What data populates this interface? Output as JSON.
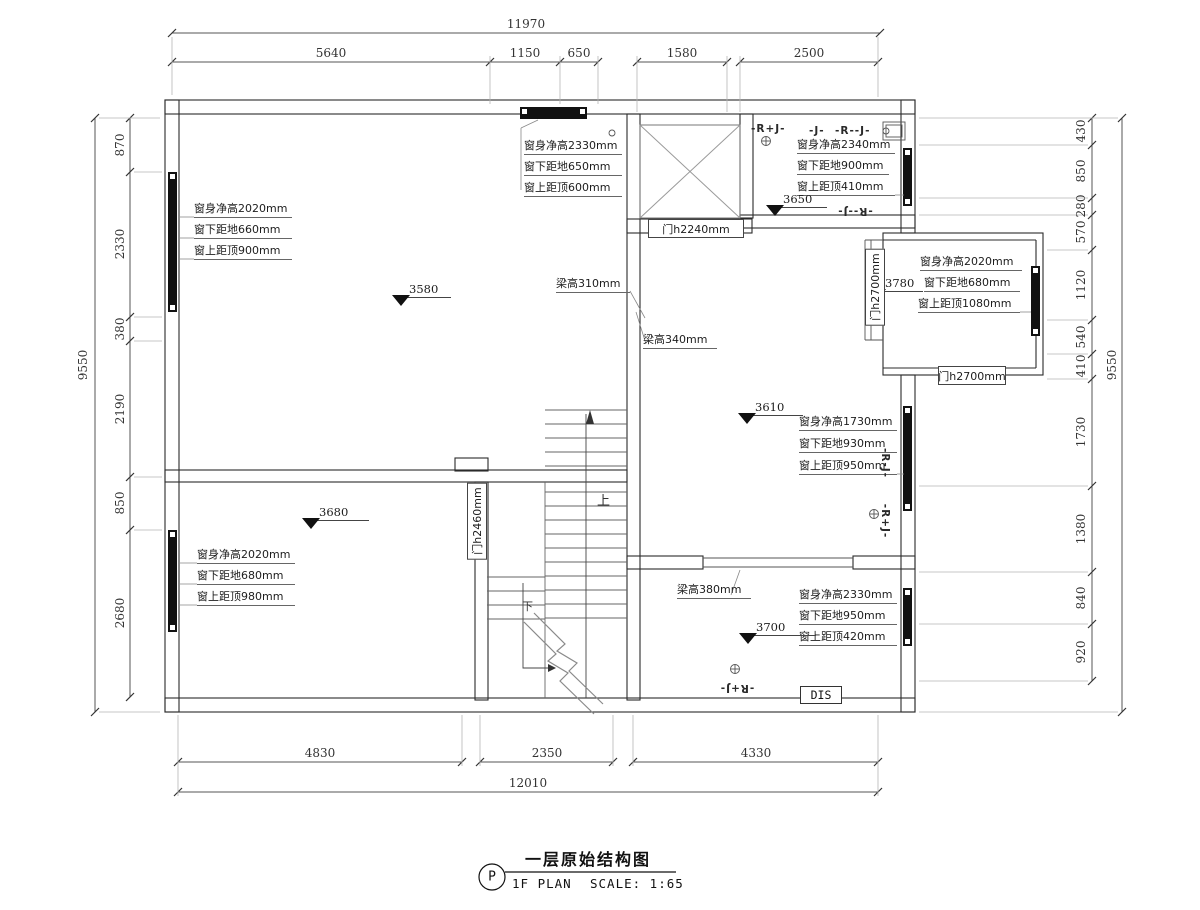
{
  "title": {
    "tag": "P",
    "cn": "一层原始结构图",
    "plan": "1F PLAN",
    "scale": "SCALE: 1:65"
  },
  "dims": {
    "top_total": "11970",
    "top": [
      "5640",
      "1150",
      "650",
      "1580",
      "2500"
    ],
    "left_total": "9550",
    "left": [
      "870",
      "2330",
      "380",
      "2190",
      "850",
      "2680"
    ],
    "right_total": "9550",
    "right": [
      "430",
      "850",
      "280",
      "570",
      "1120",
      "540",
      "410",
      "1730",
      "1380",
      "840",
      "920"
    ],
    "bottom_total": "12010",
    "bottom": [
      "4830",
      "2350",
      "4330"
    ]
  },
  "window_notes": {
    "living": [
      "窗身净高2020mm",
      "窗下距地660mm",
      "窗上距顶900mm"
    ],
    "top": [
      "窗身净高2330mm",
      "窗下距地650mm",
      "窗上距顶600mm"
    ],
    "entry": [
      "窗身净高2340mm",
      "窗下距地900mm",
      "窗上距顶410mm"
    ],
    "east": [
      "窗身净高2020mm",
      "窗下距地680mm",
      "窗上距顶1080mm"
    ],
    "right_mid": [
      "窗身净高1730mm",
      "窗下距地930mm",
      "窗上距顶950mm"
    ],
    "right_bottom": [
      "窗身净高2330mm",
      "窗下距地950mm",
      "窗上距顶420mm"
    ],
    "bottom_left": [
      "窗身净高2020mm",
      "窗下距地680mm",
      "窗上距顶980mm"
    ]
  },
  "levels": {
    "living": "3580",
    "entry": "3650",
    "east": "3780",
    "right": "3610",
    "bottom_left": "3680",
    "bottom_right": "3700"
  },
  "doors": {
    "d2240": "门h2240mm",
    "d2700a": "门h2700mm",
    "d2700b": "门h2700mm",
    "d2460": "门h2460mm"
  },
  "beams": {
    "b310": "梁高310mm",
    "b340": "梁高340mm",
    "b380": "梁高380mm"
  },
  "tags": {
    "rj_plus": "-R+J-",
    "j": "-J-",
    "rj_dash": "-R--J-",
    "rj_dash_flip": "-R--J-",
    "rj_vert": "-R-J-",
    "rj_plus_vert": "-R+J-",
    "rj_plus_flip": "-R+J-",
    "dis": "DIS"
  },
  "stairs": {
    "up": "上",
    "down": "下"
  },
  "colors": {
    "wall": "#2b2b2b",
    "line": "#555555",
    "light": "#b5b5b5",
    "window": "#111111"
  }
}
